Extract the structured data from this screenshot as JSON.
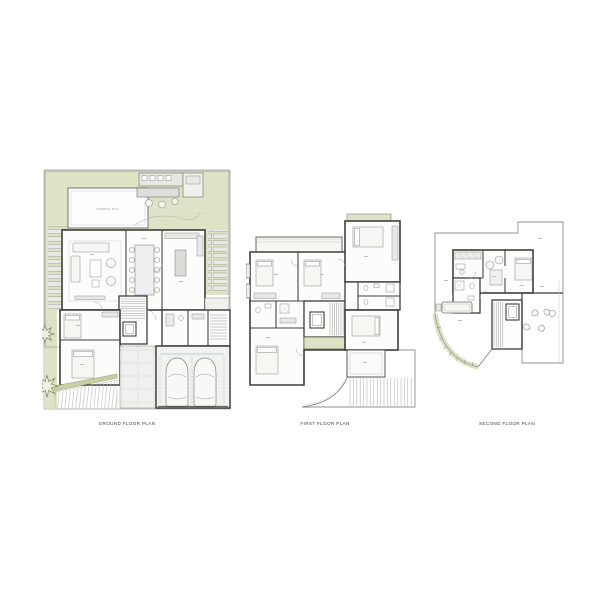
{
  "sheet": {
    "title": "Residential villa floor plan drawing sheet",
    "background_color": "#ffffff"
  },
  "plans": {
    "ground": {
      "label": "GROUND FLOOR PLAN"
    },
    "first": {
      "label": "FIRST FLOOR PLAN"
    },
    "second": {
      "label": "SECOND FLOOR PLAN"
    }
  },
  "annotations": {
    "pool_label": "SWIMMING POOL"
  },
  "colors": {
    "walls": "#3e3e3a",
    "lawn": "#e1e4c9",
    "lawn_grid_line": "#ced3b0",
    "planter_band": "#c9cfa5",
    "floor_light": "#f4f4f2",
    "furniture_line": "#90908b",
    "pool_border": "#90908b",
    "pool_inner_line": "#c3d0d4",
    "garage_floor_marking": "#a9c6d6",
    "tree_outline": "#7d8560"
  }
}
